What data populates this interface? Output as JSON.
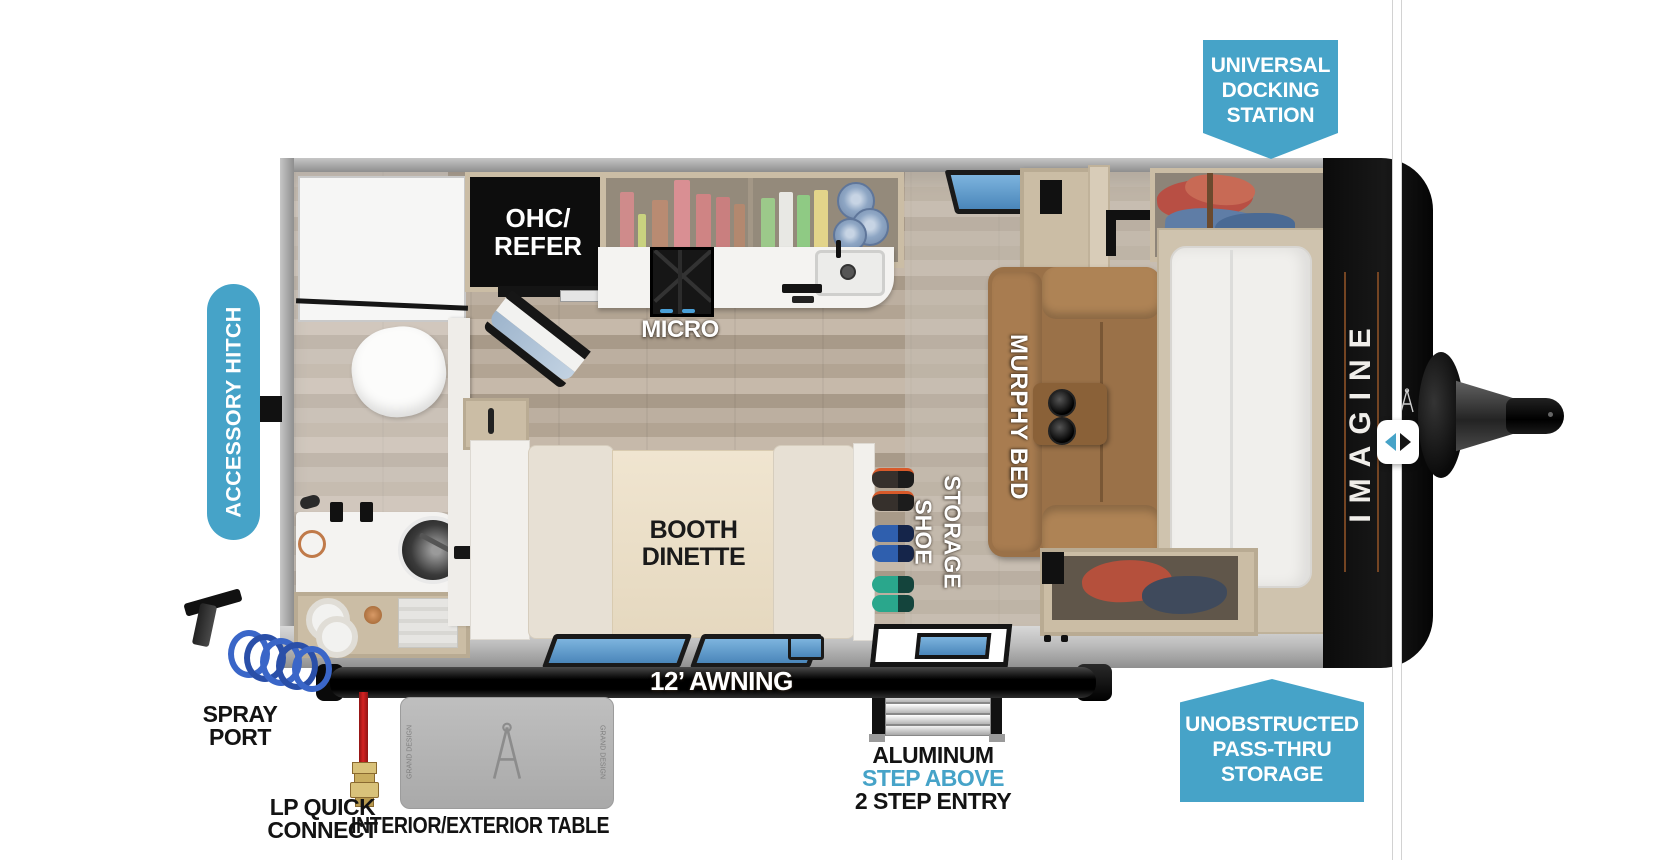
{
  "colors": {
    "accent_teal": "#46a3c8",
    "label_black": "#131313"
  },
  "badges": {
    "universal_docking_station": {
      "lines": [
        "UNIVERSAL",
        "DOCKING",
        "STATION"
      ]
    },
    "accessory_hitch": {
      "label": "ACCESSORY HITCH"
    },
    "unobstructed_pass_thru": {
      "lines": [
        "UNOBSTRUCTED",
        "PASS-THRU",
        "STORAGE"
      ]
    }
  },
  "floorplan": {
    "ohc_refer": {
      "lines": [
        "OHC/",
        "REFER"
      ]
    },
    "micro": "MICRO",
    "murphy_bed": "MURPHY BED",
    "booth_dinette": {
      "lines": [
        "BOOTH",
        "DINETTE"
      ]
    },
    "shoe_storage": {
      "lines": [
        "SHOE",
        "STORAGE"
      ]
    },
    "awning": "12’ AWNING",
    "brand_vertical": "IMAGINE",
    "table_side_text": "GRAND DESIGN"
  },
  "callouts": {
    "spray_port": {
      "lines": [
        "SPRAY",
        "PORT"
      ]
    },
    "lp_quick_connect": {
      "lines": [
        "LP QUICK",
        "CONNECT"
      ]
    },
    "interior_exterior_table": "INTERIOR/EXTERIOR TABLE",
    "entry_step": {
      "line1": "ALUMINUM",
      "line2": "STEP ABOVE",
      "line3": "2 STEP ENTRY"
    }
  }
}
